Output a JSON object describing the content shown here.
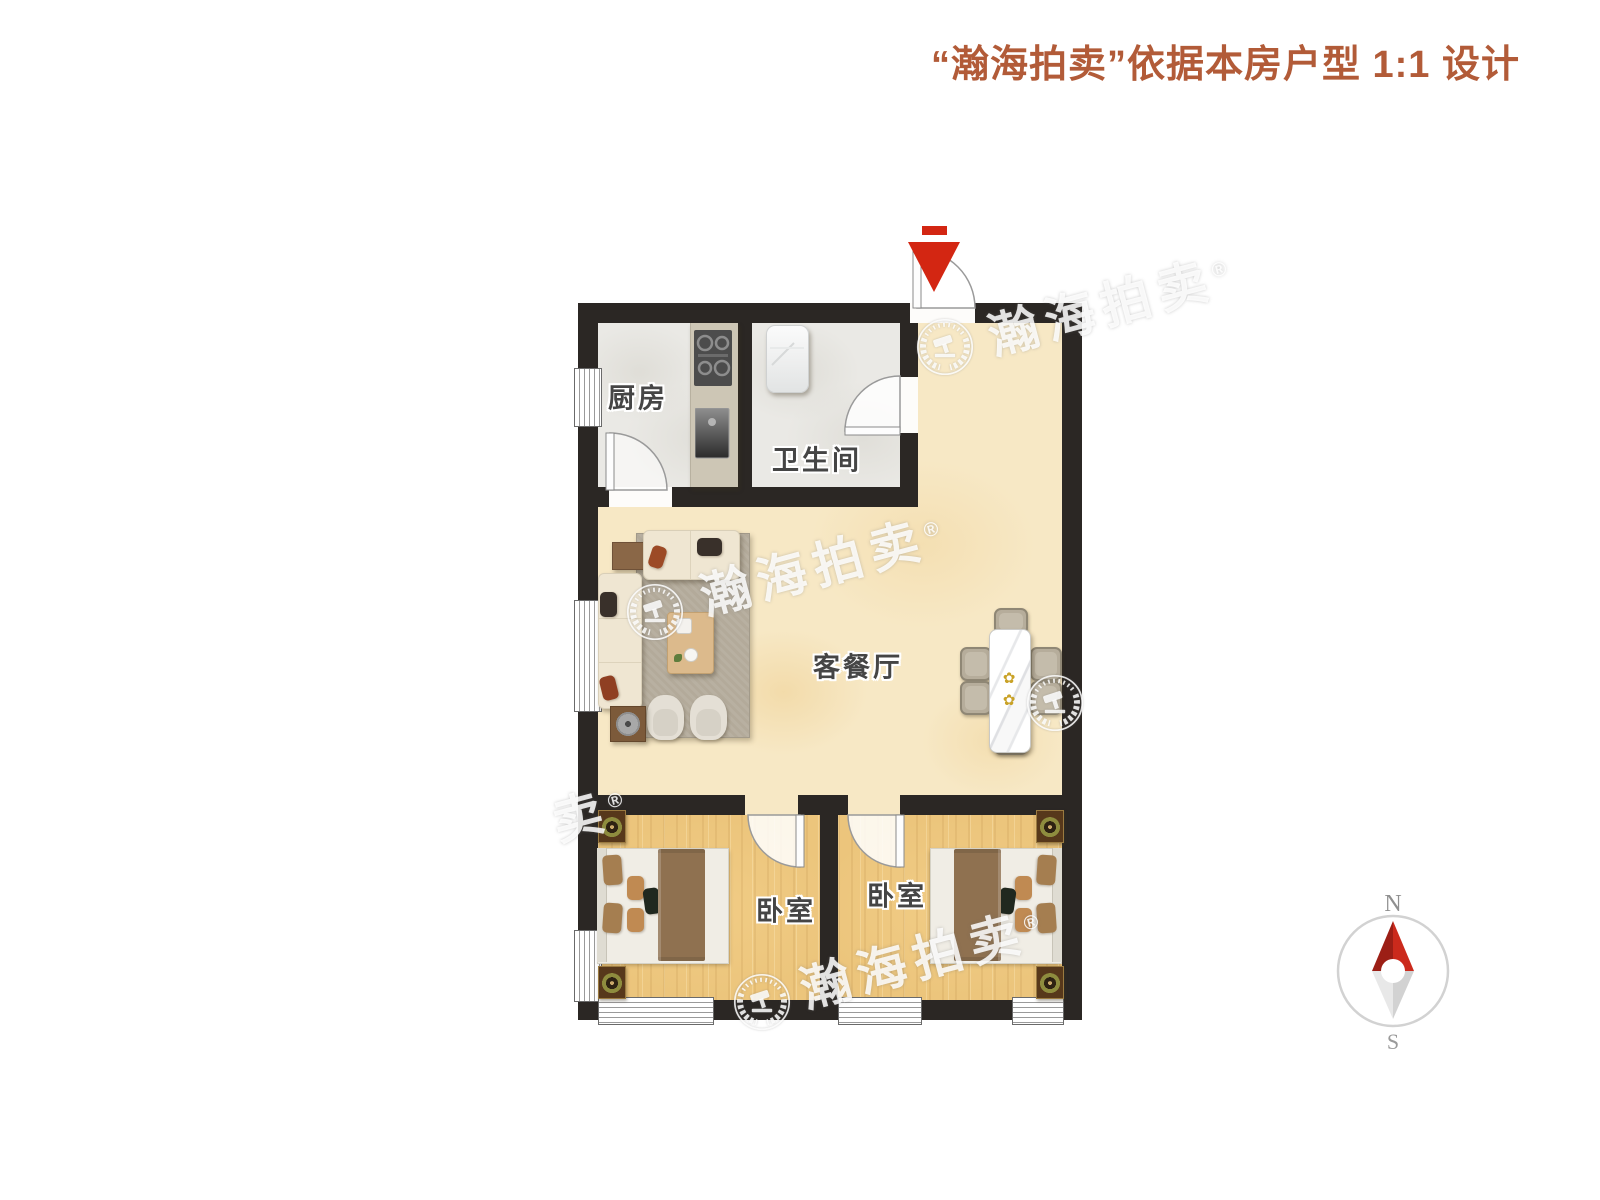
{
  "header": {
    "title": "“瀚海拍卖”依据本房户型 1:1 设计"
  },
  "plan": {
    "rooms": {
      "kitchen": {
        "label": "厨房"
      },
      "bathroom": {
        "label": "卫生间"
      },
      "living_dining": {
        "label": "客餐厅"
      },
      "bedroom_left": {
        "label": "卧室"
      },
      "bedroom_right": {
        "label": "卧室"
      }
    }
  },
  "watermark": {
    "brand": "瀚海拍卖",
    "registered": "®",
    "partial": "卖"
  },
  "compass": {
    "north": "N",
    "south": "S"
  },
  "colors": {
    "title_text": "#b25b38",
    "wall": "#2b2724",
    "floor_living": "#f7e8c5",
    "floor_wood": "#ecc57c",
    "floor_tile": "#eae9e5",
    "entrance_arrow": "#d32612",
    "compass_north_red": "#cb2a1c"
  }
}
